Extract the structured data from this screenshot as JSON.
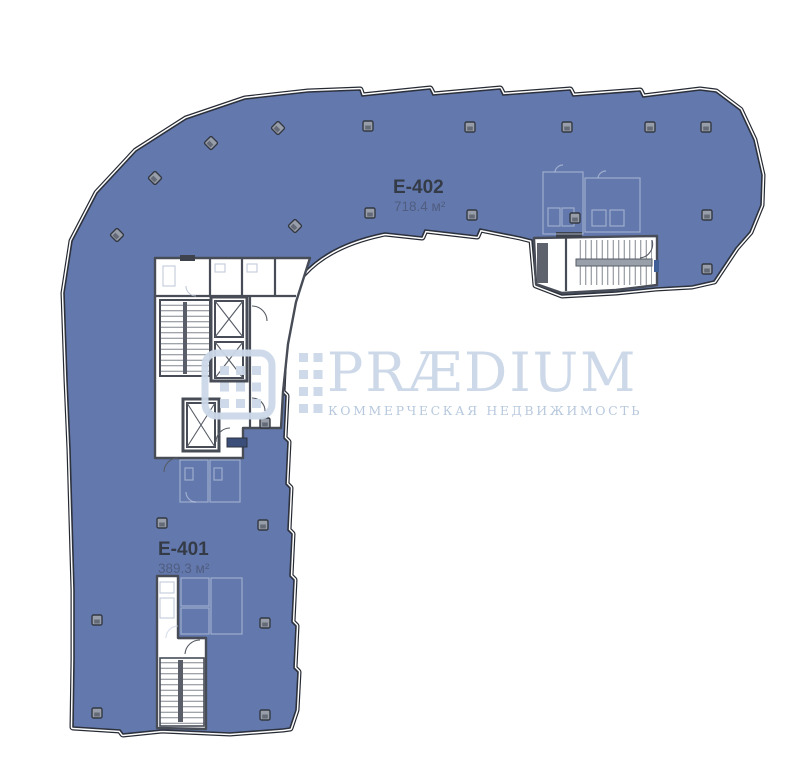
{
  "page": {
    "background_color": "#ffffff"
  },
  "floor_plan": {
    "highlight_color": "#6379ae",
    "outline_color": "#2c313c",
    "units": [
      {
        "code": "E-402",
        "area": "718.4 м²"
      },
      {
        "code": "E-401",
        "area": "389.3 м²"
      }
    ]
  },
  "watermark": {
    "brand": "PRÆDIUM",
    "tagline": "КОММЕРЧЕСКАЯ НЕДВИЖИМОСТЬ",
    "brand_color": "#cbd8e8",
    "tagline_color": "#b4c6dc"
  }
}
